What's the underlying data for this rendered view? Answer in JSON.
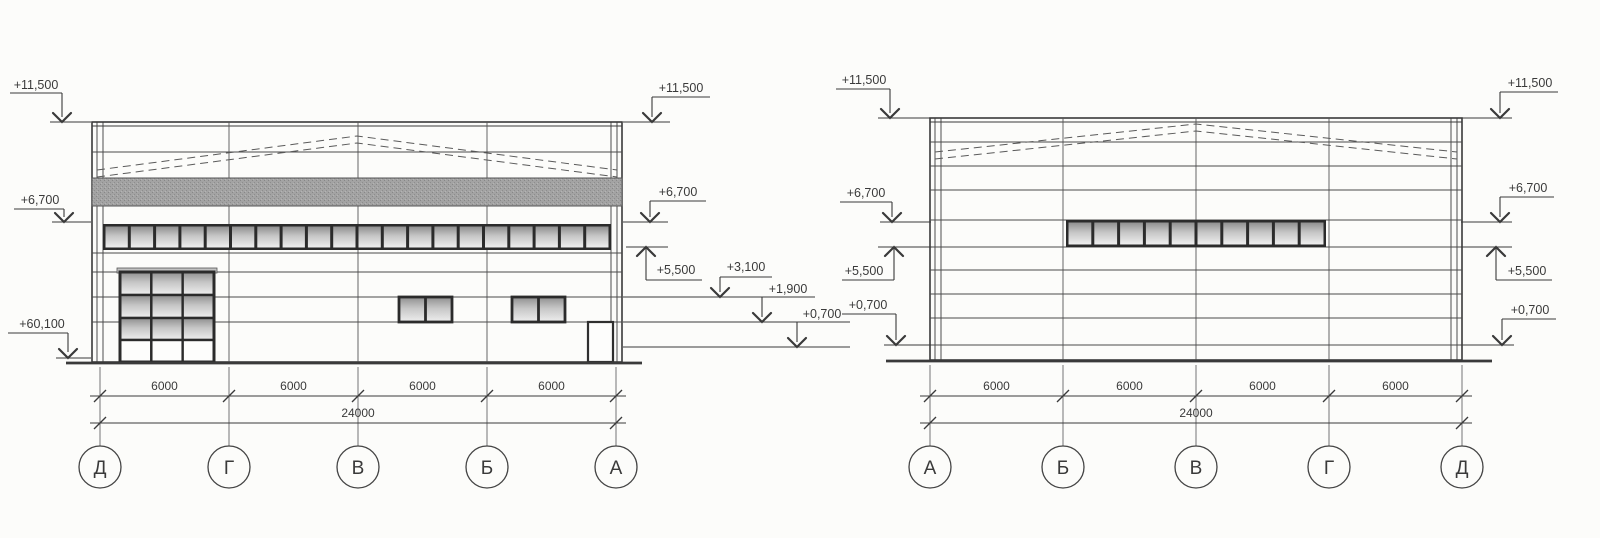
{
  "sheet": {
    "background": "#fcfcfa",
    "ink": "#3a3a3a",
    "glazing_dark": "#8f8f8f",
    "glazing_light": "#efefef",
    "band_gray": "#a3a3a3"
  },
  "elevations": [
    {
      "title": "left-elevation",
      "axis_labels": [
        "Д",
        "Г",
        "В",
        "Б",
        "А"
      ],
      "bay_dims": [
        "6000",
        "6000",
        "6000",
        "6000"
      ],
      "total_dim": "24000",
      "marks_left": [
        {
          "label": "+11,500"
        },
        {
          "label": "+6,700"
        },
        {
          "label": "+60,100"
        }
      ],
      "marks_right": [
        {
          "label": "+11,500"
        },
        {
          "label": "+6,700"
        },
        {
          "label": "+5,500"
        },
        {
          "label": "+3,100"
        },
        {
          "label": "+1,900"
        },
        {
          "label": "+0,700"
        }
      ],
      "window_ribbon_count": 20,
      "gate": {
        "cols": 3,
        "rows": 4,
        "glazed_rows": 3
      },
      "small_window_count": 2,
      "door_count": 1
    },
    {
      "title": "right-elevation",
      "axis_labels": [
        "А",
        "Б",
        "В",
        "Г",
        "Д"
      ],
      "bay_dims": [
        "6000",
        "6000",
        "6000",
        "6000"
      ],
      "total_dim": "24000",
      "marks_left": [
        {
          "label": "+11,500"
        },
        {
          "label": "+6,700"
        },
        {
          "label": "+5,500"
        },
        {
          "label": "+0,700"
        }
      ],
      "marks_right": [
        {
          "label": "+11,500"
        },
        {
          "label": "+6,700"
        },
        {
          "label": "+5,500"
        },
        {
          "label": "+0,700"
        }
      ],
      "window_band_count": 10
    }
  ]
}
